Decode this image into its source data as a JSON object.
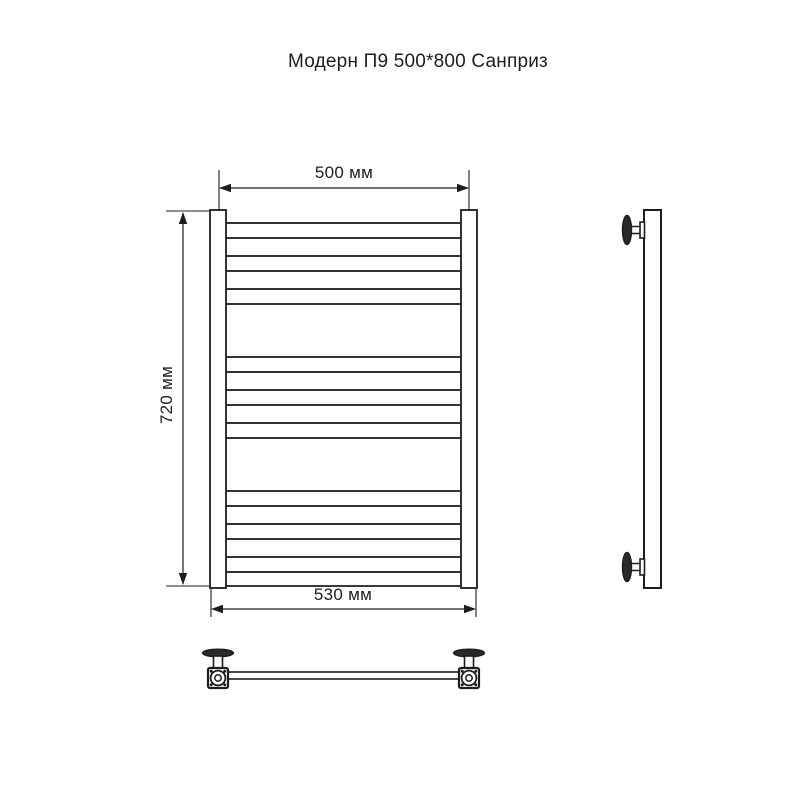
{
  "title": "Модерн П9 500*800 Санприз",
  "colors": {
    "background": "#ffffff",
    "line": "#1d1d1d"
  },
  "dims": {
    "top_width": {
      "label": "500 мм",
      "value": 500,
      "unit": "мм"
    },
    "height": {
      "label": "720 мм",
      "value": 720,
      "unit": "мм"
    },
    "bottom_width": {
      "label": "530 мм",
      "value": 530,
      "ununit": "мм",
      "unit": "мм"
    }
  },
  "diagram": {
    "type": "technical-drawing",
    "views": [
      "front",
      "side",
      "bottom"
    ],
    "rail_count": 9,
    "front": {
      "post_top": 210,
      "post_bottom": 588,
      "post_width": 16,
      "post_left_x": 210,
      "post_right_x": 461,
      "rail_x1": 225,
      "rail_x2": 462,
      "rail_height": 15,
      "rail_groups": [
        [
          223,
          256,
          289
        ],
        [
          357,
          390,
          423
        ],
        [
          491,
          524,
          557
        ]
      ],
      "bottom_bar_y": 586
    },
    "dim500": {
      "ext_xs": [
        219,
        469
      ],
      "ext_y1": 170,
      "ext_y2": 211,
      "line_y": 188
    },
    "dim720": {
      "ext_ys": [
        211,
        586
      ],
      "ext_x1": 166,
      "ext_x2": 209,
      "line_x": 183
    },
    "dim530": {
      "ext_xs": [
        211,
        476
      ],
      "ext_y1": 589,
      "ext_y2": 617,
      "line_y": 609
    },
    "side": {
      "x": 644,
      "y1": 210,
      "y2": 588,
      "width": 17,
      "bracket_cys": [
        230,
        567
      ],
      "disc_cx": 627,
      "disc_rx": 4.5,
      "disc_ry": 14.5,
      "stem_x1": 629,
      "stem_half": 3.5,
      "collar_x": 640,
      "collar_w": 4.5,
      "collar_half": 8
    },
    "bottom": {
      "cxs": [
        218,
        469
      ],
      "flange_cy": 653,
      "flange_rx": 15.5,
      "flange_ry": 3.8,
      "stem_w": 9,
      "stem_y1": 656,
      "square_y": 668,
      "square_size": 20,
      "circle_r": 7.4,
      "inner_r": 3.2,
      "bolt_off": 6.8,
      "bolt_r": 1.5,
      "tube_y": 672,
      "tube_h": 7
    }
  }
}
